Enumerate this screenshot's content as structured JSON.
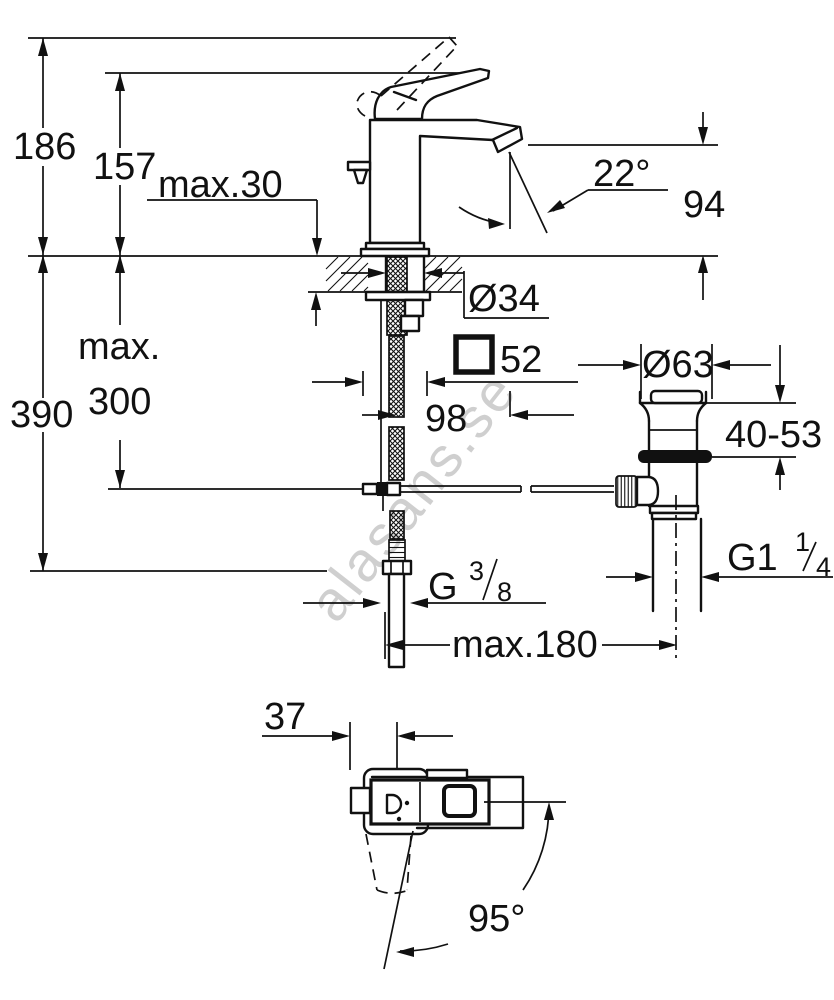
{
  "drawing": {
    "background": "#ffffff",
    "line_color": "#111111",
    "watermark": {
      "text": "alasans.se",
      "color": "#c7c7c7"
    },
    "front_view": {
      "labels": {
        "total_height": "186",
        "lever_height": "157",
        "deck_max_thickness": "max.30",
        "spout_angle": "22°",
        "spout_height": "94",
        "hose_max_prefix": "max.",
        "hose_max_length": "300",
        "under_deck_depth": "390",
        "hole_diameter": "Ø34",
        "body_width": "52",
        "spout_projection": "98",
        "waste_cap_diameter": "Ø63",
        "waste_deck_range": "40-53",
        "waste_thread_prefix": "G1",
        "waste_thread_numerator": "1",
        "waste_thread_denominator": "4",
        "supply_thread_prefix": "G",
        "supply_thread_numerator": "3",
        "supply_thread_denominator": "8",
        "rod_max_reach": "max.180"
      }
    },
    "plan_view": {
      "labels": {
        "lever_offset": "37",
        "lever_swing_angle": "95°"
      }
    }
  }
}
